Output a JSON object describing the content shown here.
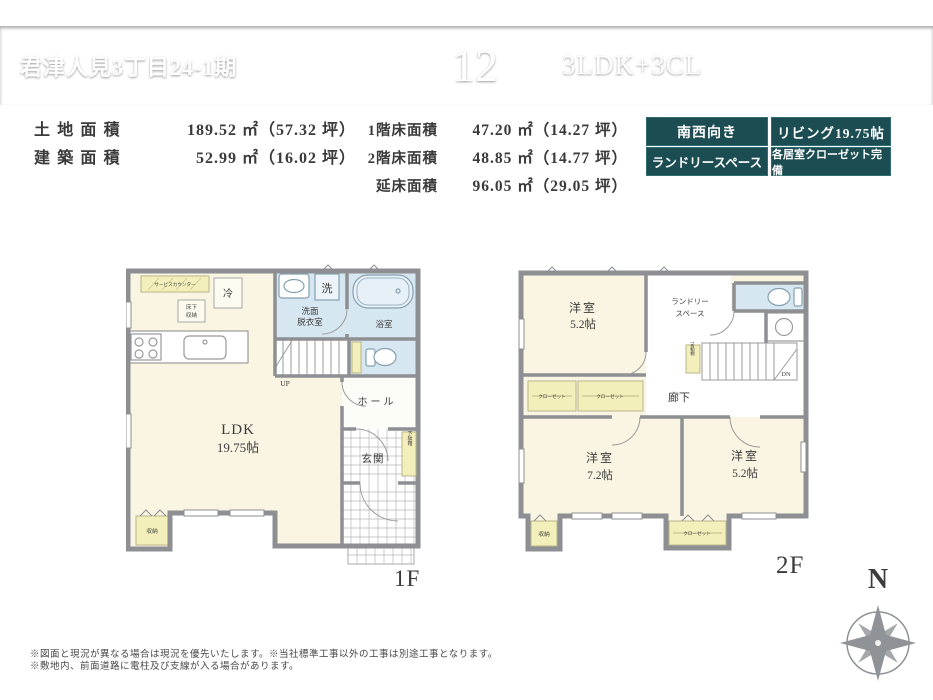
{
  "header": {
    "project_title": "君津人見3丁目24-1期",
    "project_note": "（13棟現場）",
    "unit_number": "12",
    "unit_label": "号棟",
    "floor_plan_type": "3LDK+3CL"
  },
  "areas": {
    "left": [
      {
        "label": "土地面積",
        "value": "189.52 ㎡（57.32 坪）"
      },
      {
        "label": "建築面積",
        "value": "52.99 ㎡（16.02 坪）"
      }
    ],
    "right": [
      {
        "label": "1階床面積",
        "value": "47.20 ㎡（14.27 坪）"
      },
      {
        "label": "2階床面積",
        "value": "48.85 ㎡（14.77 坪）"
      },
      {
        "label": "延床面積",
        "value": "96.05 ㎡（29.05 坪）"
      }
    ]
  },
  "badges": [
    {
      "label": "南西向き"
    },
    {
      "label": "リビング19.75帖"
    },
    {
      "label": "ランドリースペース"
    },
    {
      "label": "各居室クローゼット完備"
    }
  ],
  "floor1": {
    "label": "1F",
    "ldk": "LDK",
    "ldk_size": "19.75帖",
    "counter": "サービスカウンター",
    "fridge": "冷",
    "floor_storage_1": "床下",
    "floor_storage_2": "収納",
    "washer": "洗",
    "washroom_1": "洗面",
    "washroom_2": "脱衣室",
    "bathroom": "浴室",
    "up": "UP",
    "hall": "ホール",
    "entrance": "玄関",
    "shoe_cabinet": "下駄箱",
    "storage": "収納"
  },
  "floor2": {
    "label": "2F",
    "room_a": "洋室",
    "room_a_size": "5.2帖",
    "laundry_1": "ランドリー",
    "laundry_2": "スペース",
    "movable_shelf": "可動棚",
    "down": "DN",
    "hallway": "廊下",
    "room_b": "洋室",
    "room_b_size": "7.2帖",
    "room_c": "洋室",
    "room_c_size": "5.2帖",
    "storage": "収納",
    "closet_a": "クローゼット",
    "closet_b": "クローゼット",
    "closet_c": "クローゼット"
  },
  "compass": {
    "north": "N"
  },
  "footnotes": {
    "line1": "※図面と現況が異なる場合は現況を優先いたします。※当社標準工事以外の工事は別途工事となります。",
    "line2": "※敷地内、前面道路に電柱及び支線が入る場合があります。"
  }
}
